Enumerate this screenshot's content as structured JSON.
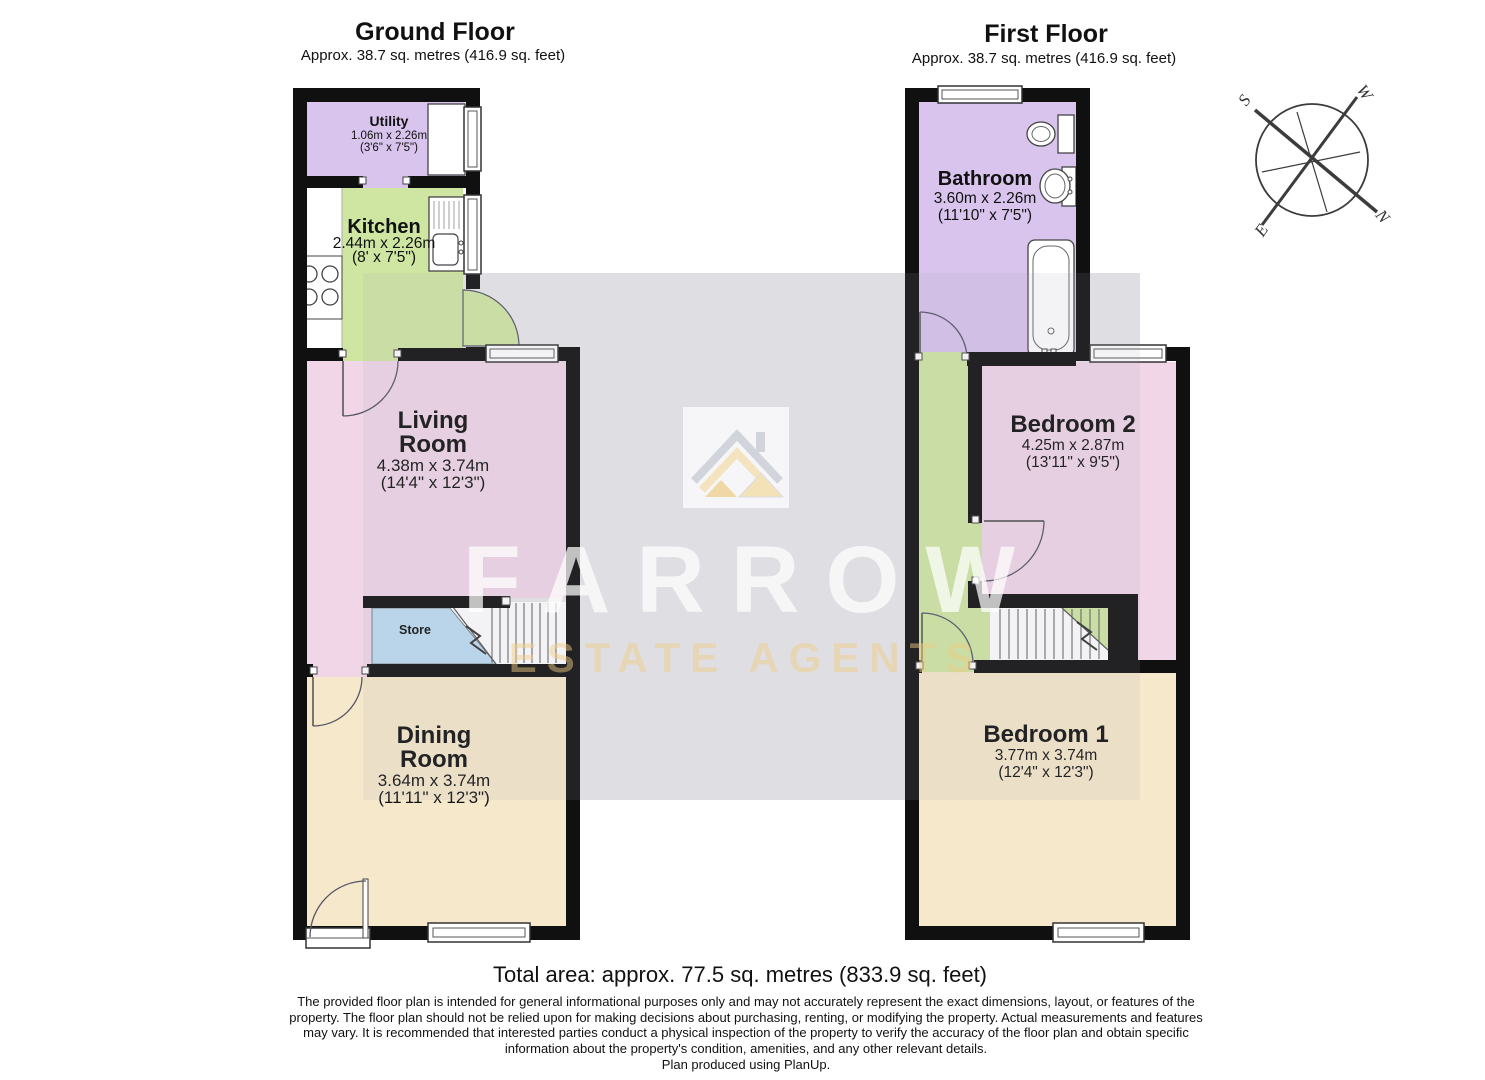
{
  "header": {
    "ground_floor": {
      "title": "Ground Floor",
      "subtitle": "Approx. 38.7 sq. metres (416.9 sq. feet)"
    },
    "first_floor": {
      "title": "First Floor",
      "subtitle": "Approx. 38.7 sq. metres (416.9 sq. feet)"
    }
  },
  "rooms": {
    "utility": {
      "name": "Utility",
      "dims_m": "1.06m x 2.26m",
      "dims_ft": "(3'6\" x 7'5\")"
    },
    "kitchen": {
      "name": "Kitchen",
      "dims_m": "2.44m x 2.26m",
      "dims_ft": "(8' x 7'5\")"
    },
    "living_room": {
      "name_line1": "Living",
      "name_line2": "Room",
      "dims_m": "4.38m x 3.74m",
      "dims_ft": "(14'4\" x 12'3\")"
    },
    "store": {
      "name": "Store"
    },
    "dining_room": {
      "name_line1": "Dining",
      "name_line2": "Room",
      "dims_m": "3.64m x 3.74m",
      "dims_ft": "(11'11\" x 12'3\")"
    },
    "bathroom": {
      "name": "Bathroom",
      "dims_m": "3.60m x 2.26m",
      "dims_ft": "(11'10\" x 7'5\")"
    },
    "bedroom_2": {
      "name": "Bedroom 2",
      "dims_m": "4.25m x 2.87m",
      "dims_ft": "(13'11\" x 9'5\")"
    },
    "bedroom_1": {
      "name": "Bedroom 1",
      "dims_m": "3.77m x 3.74m",
      "dims_ft": "(12'4\" x 12'3\")"
    }
  },
  "compass": {
    "north": "N",
    "south": "S",
    "east": "E",
    "west": "W"
  },
  "watermark": {
    "brand": "FARROW",
    "tagline": "ESTATE AGENTS"
  },
  "footer": {
    "total_area": "Total area: approx. 77.5 sq. metres (833.9 sq. feet)",
    "disclaimer_line1": "The provided floor plan is intended for general informational purposes only and may not accurately represent the exact dimensions, layout, or features of the",
    "disclaimer_line2": "property. The floor plan should not be relied upon for making decisions about purchasing, renting, or modifying the property. Actual measurements and features",
    "disclaimer_line3": "may vary. It is recommended that interested parties conduct a physical inspection of the property to verify the accuracy of the floor plan and obtain specific",
    "disclaimer_line4": "information about the property's condition, amenities, and any other relevant details.",
    "disclaimer_line5": "Plan produced using PlanUp."
  },
  "colors": {
    "wall": "#101010",
    "room_purple": "#d9c4ee",
    "room_green": "#cfe6a2",
    "room_pink": "#f1d6e8",
    "room_beige": "#f6e8cb",
    "room_blue": "#bedcf2",
    "watermark_band": "#e8e8eb",
    "watermark_gold": "#eecd86"
  }
}
